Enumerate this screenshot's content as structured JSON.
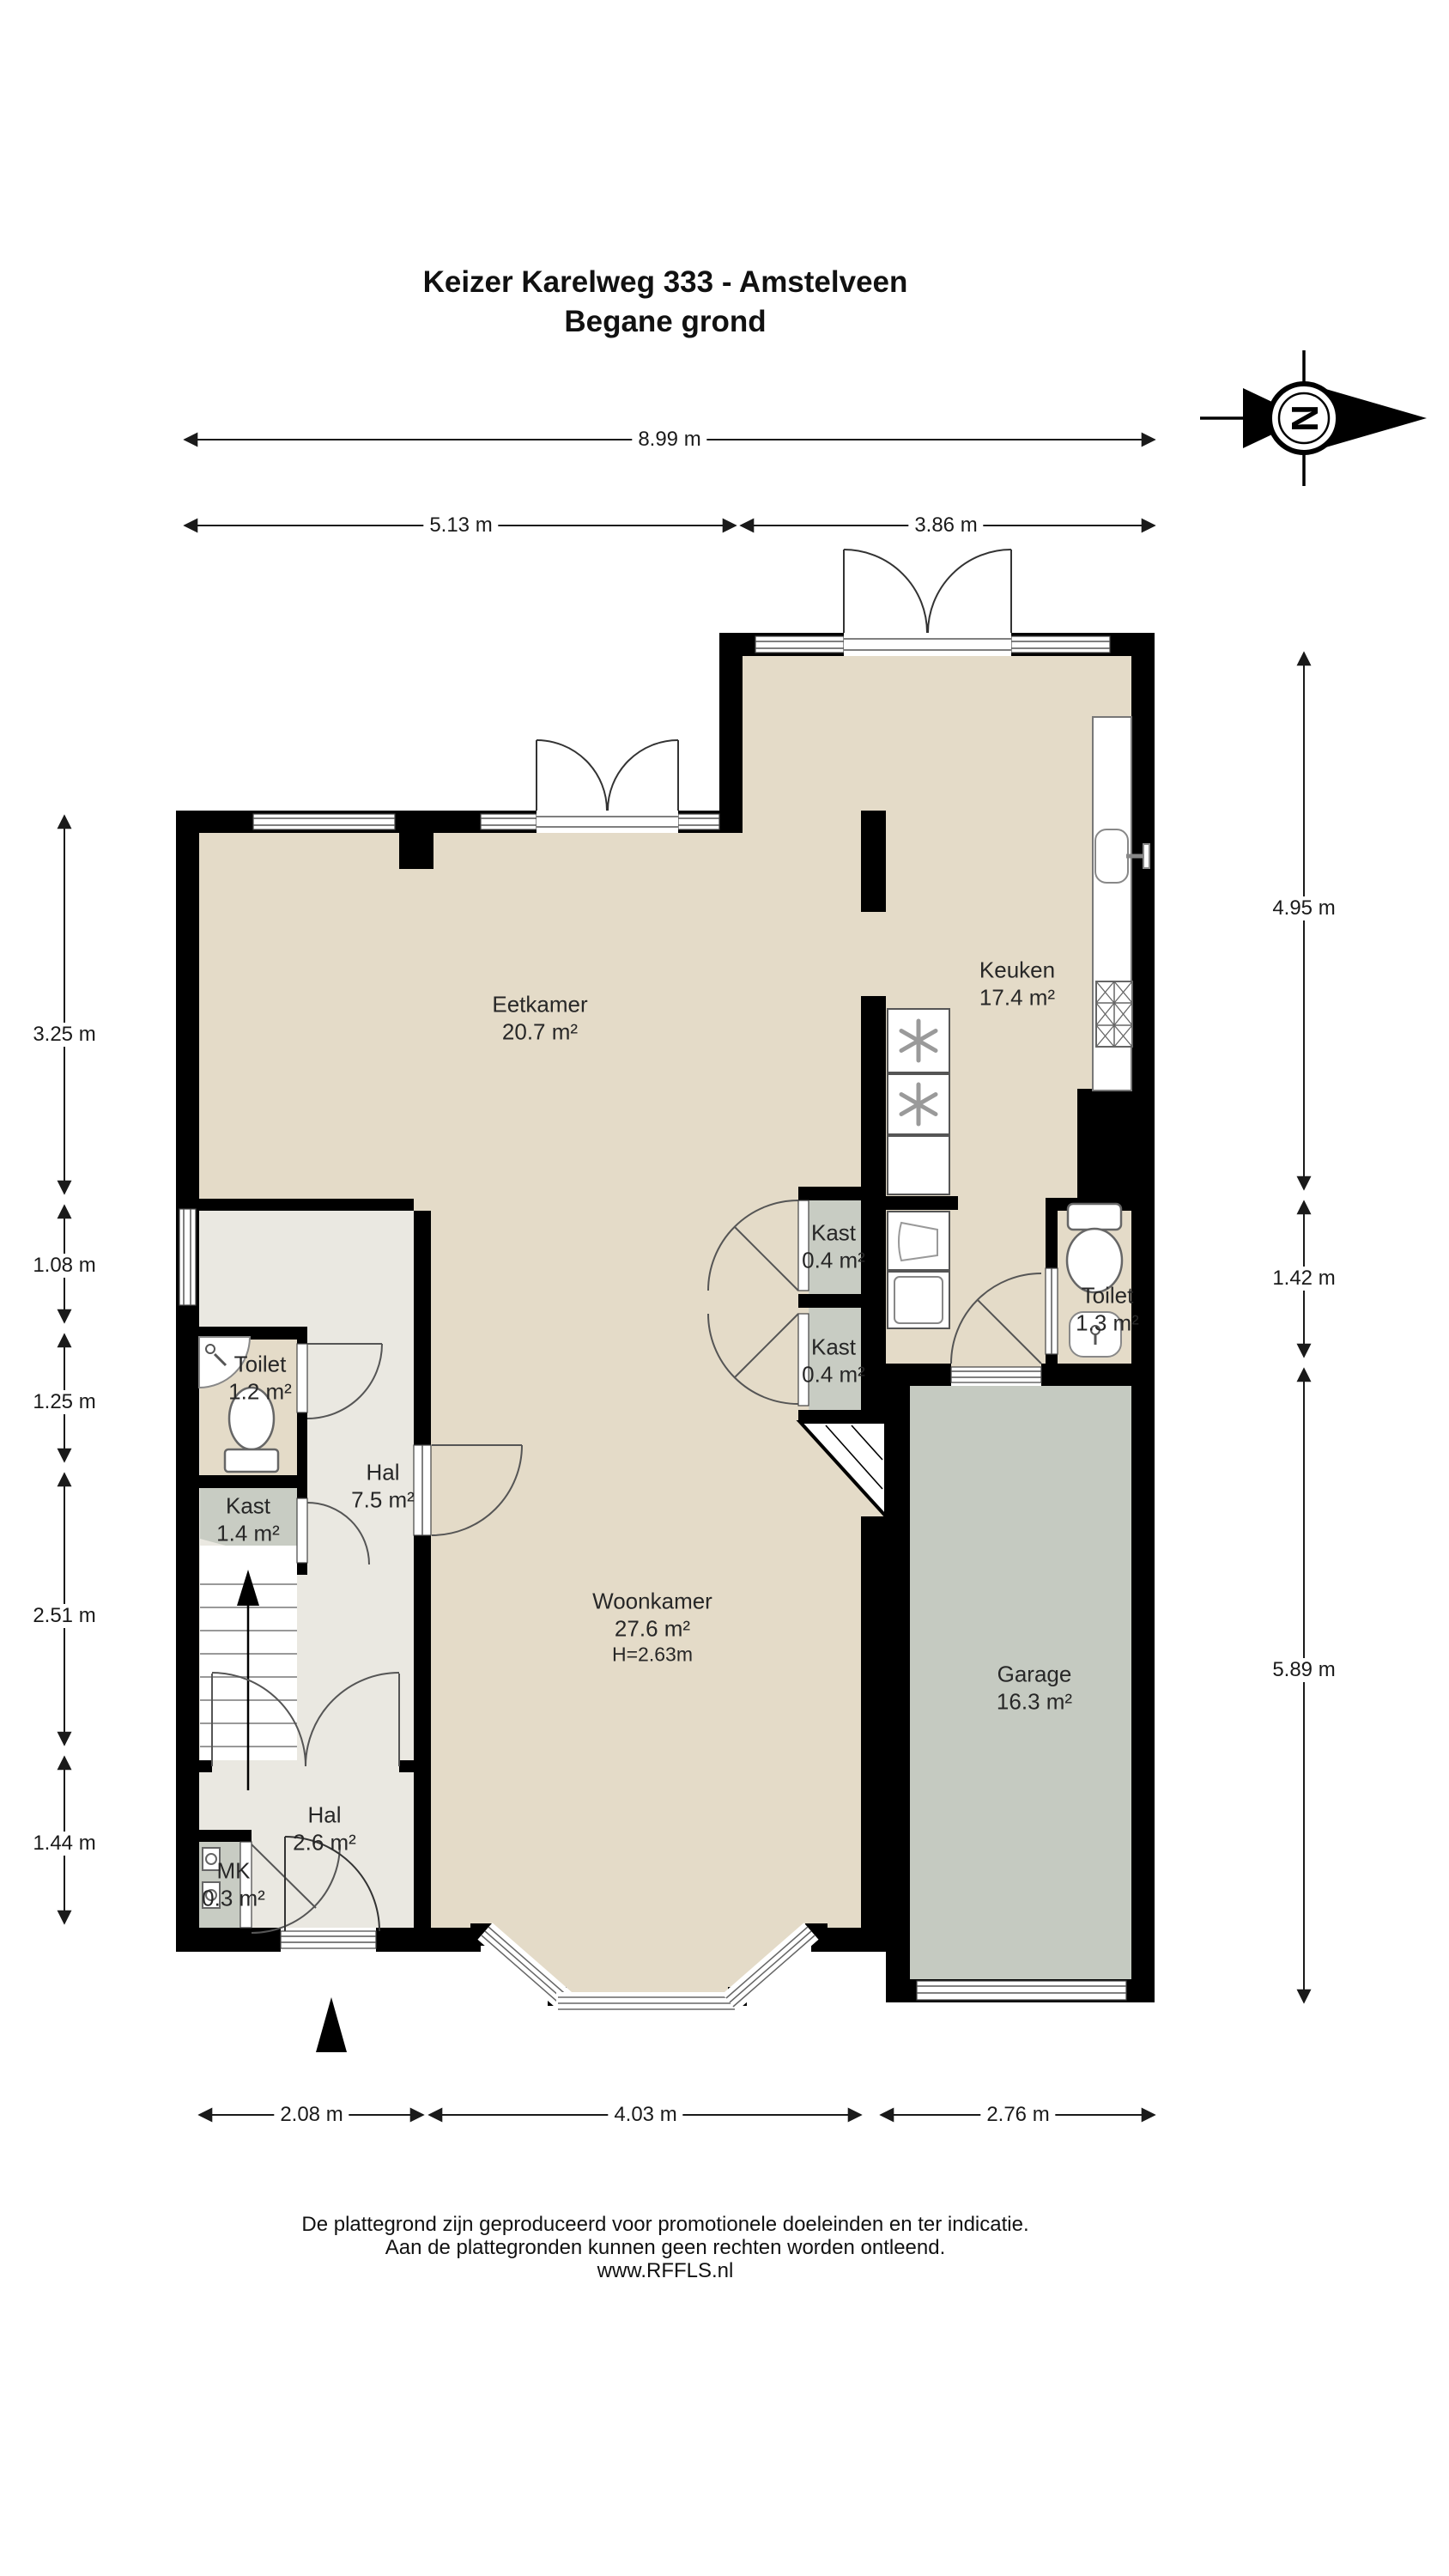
{
  "title": {
    "line1": "Keizer Karelweg 333 - Amstelveen",
    "line2": "Begane grond"
  },
  "compass": {
    "letter": "N"
  },
  "rooms": {
    "eetkamer": {
      "name": "Eetkamer",
      "area": "20.7 m²"
    },
    "keuken": {
      "name": "Keuken",
      "area": "17.4 m²"
    },
    "kast_center_top": {
      "name": "Kast",
      "area": "0.4 m²"
    },
    "kast_center_bot": {
      "name": "Kast",
      "area": "0.4 m²"
    },
    "toilet_rechts": {
      "name": "Toilet",
      "area": "1.3 m²"
    },
    "toilet_links": {
      "name": "Toilet",
      "area": "1.2 m²"
    },
    "hal_groot": {
      "name": "Hal",
      "area": "7.5 m²"
    },
    "kast_links": {
      "name": "Kast",
      "area": "1.4 m²"
    },
    "woonkamer": {
      "name": "Woonkamer",
      "area": "27.6 m²",
      "height": "H=2.63m"
    },
    "garage": {
      "name": "Garage",
      "area": "16.3 m²"
    },
    "hal_entree": {
      "name": "Hal",
      "area": "2.6 m²"
    },
    "mk": {
      "name": "MK",
      "area": "0.3 m²"
    }
  },
  "dimensions": {
    "top": [
      "8.99 m",
      "5.13 m",
      "3.86 m"
    ],
    "left": [
      "3.25 m",
      "1.08 m",
      "1.25 m",
      "2.51 m",
      "1.44 m"
    ],
    "right": [
      "4.95 m",
      "1.42 m",
      "5.89 m"
    ],
    "bottom": [
      "2.08 m",
      "4.03 m",
      "2.76 m"
    ]
  },
  "footer": {
    "line1": "De plattegrond zijn geproduceerd voor promotionele doeleinden en ter indicatie.",
    "line2": "Aan de plattegronden kunnen geen rechten worden ontleend.",
    "line3": "www.RFFLS.nl"
  },
  "colors": {
    "wall": "#000000",
    "floor_main": "#e4dbc8",
    "floor_hall": "#eae8e1",
    "floor_closet": "#c8ccc3",
    "floor_garage": "#c5cac1"
  }
}
